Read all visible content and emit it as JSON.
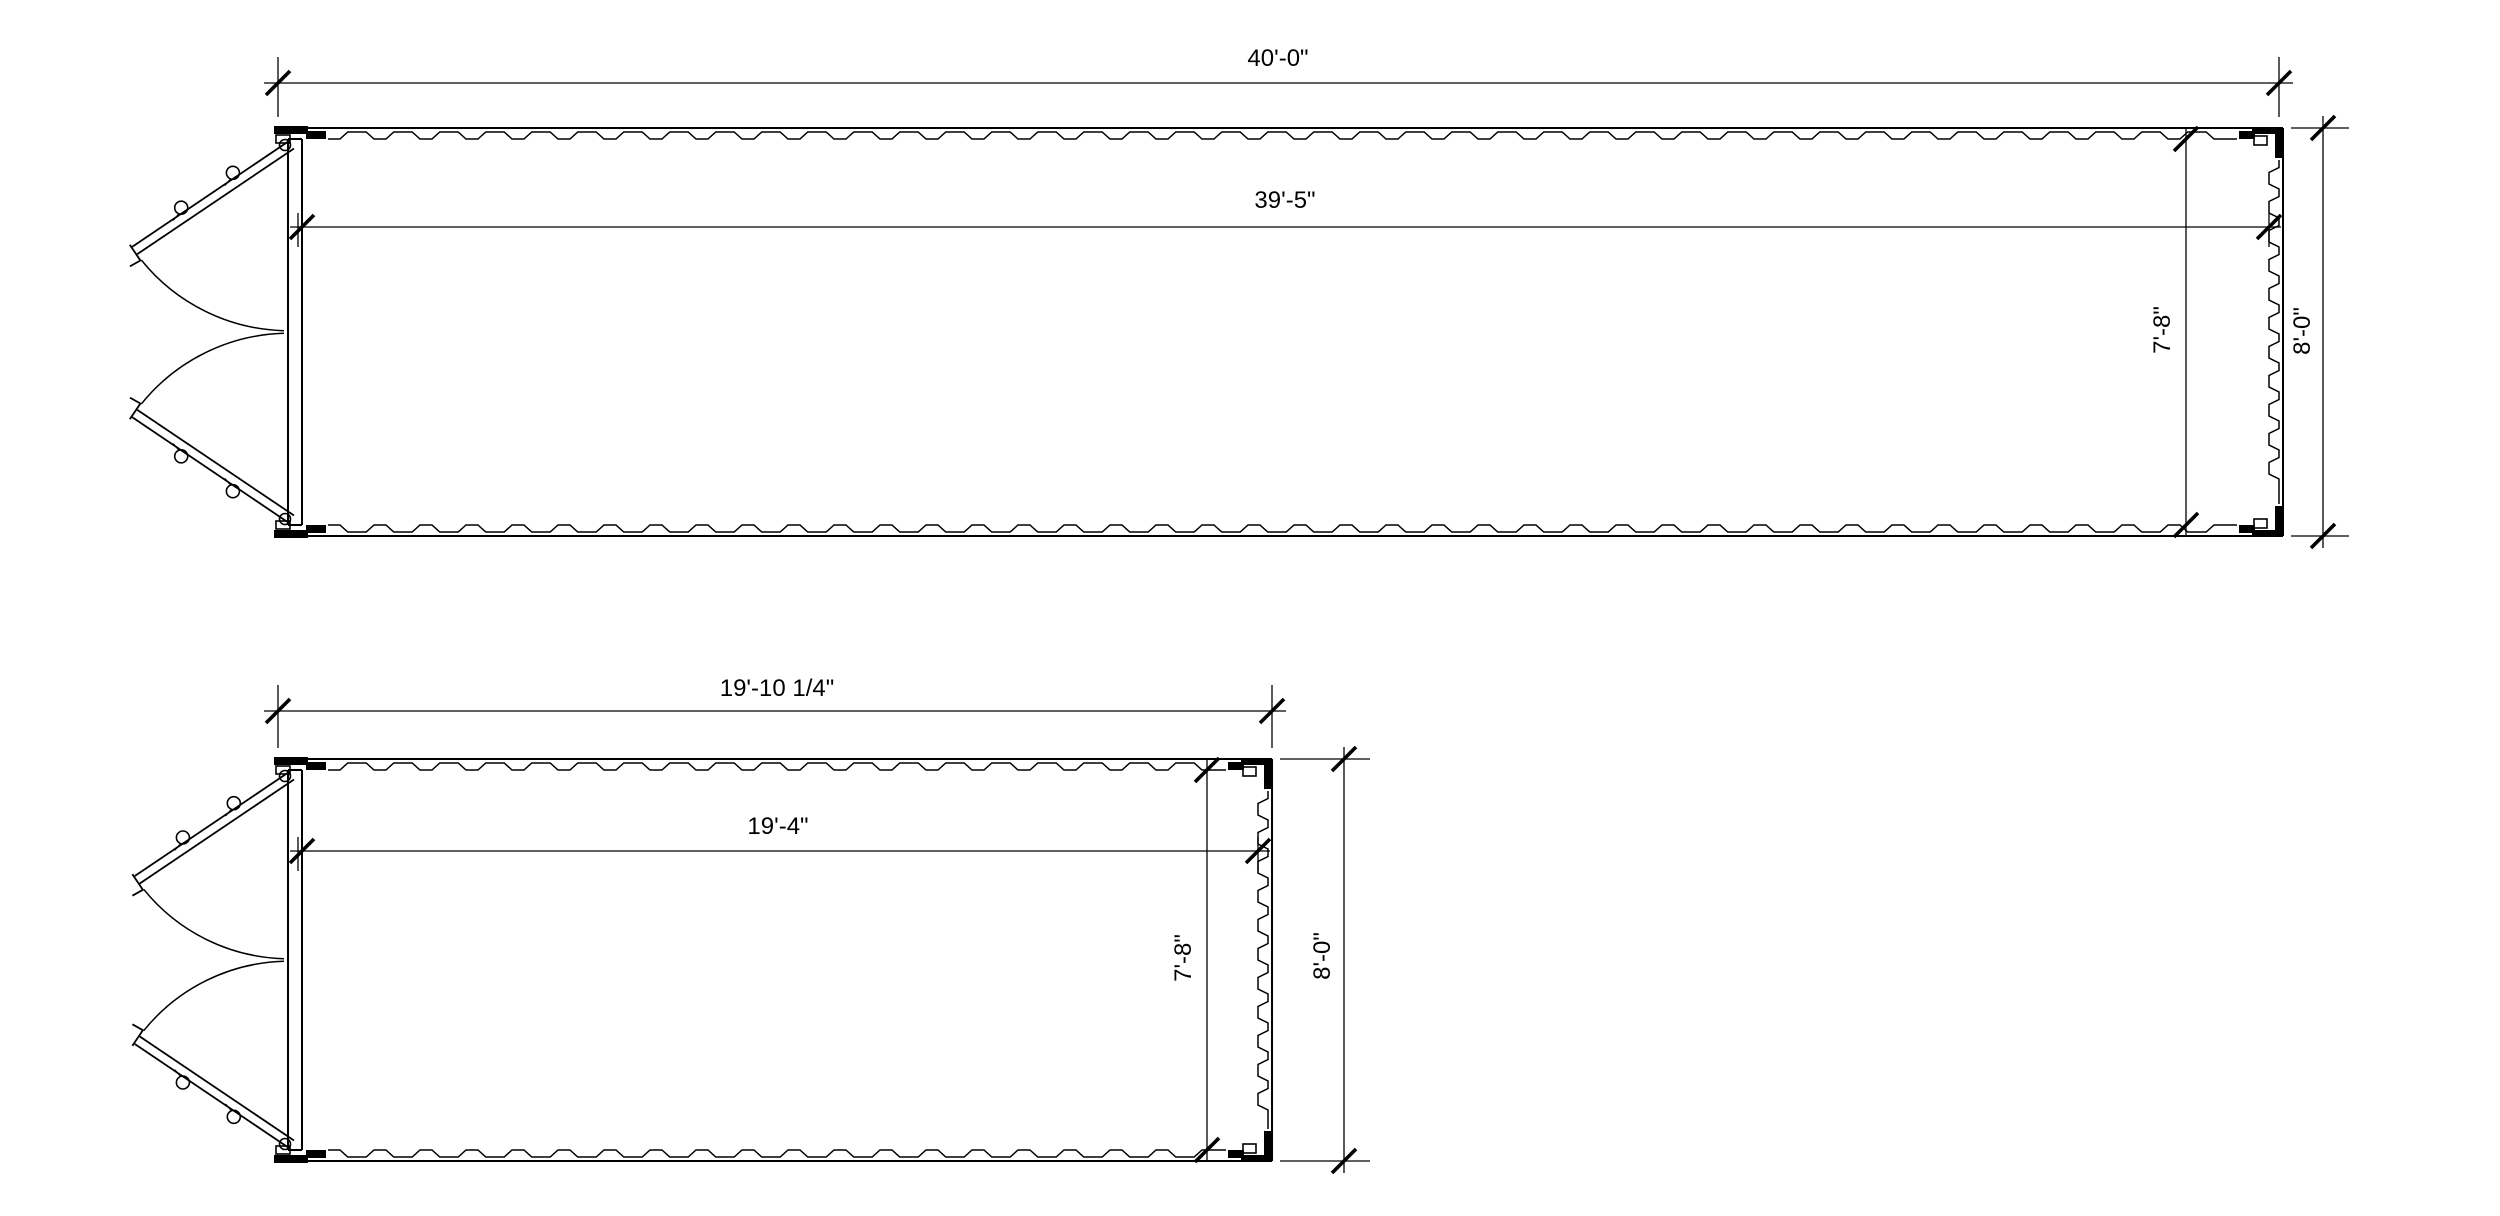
{
  "drawing": {
    "background_color": "#ffffff",
    "line_color": "#000000",
    "containers": [
      {
        "overall_length": "40'-0\"",
        "interior_length": "39'-5\"",
        "interior_width": "7'-8\"",
        "overall_width": "8'-0\""
      },
      {
        "overall_length": "19'-10 1/4\"",
        "interior_length": "19'-4\"",
        "interior_width": "7'-8\"",
        "overall_width": "8'-0\""
      }
    ]
  }
}
